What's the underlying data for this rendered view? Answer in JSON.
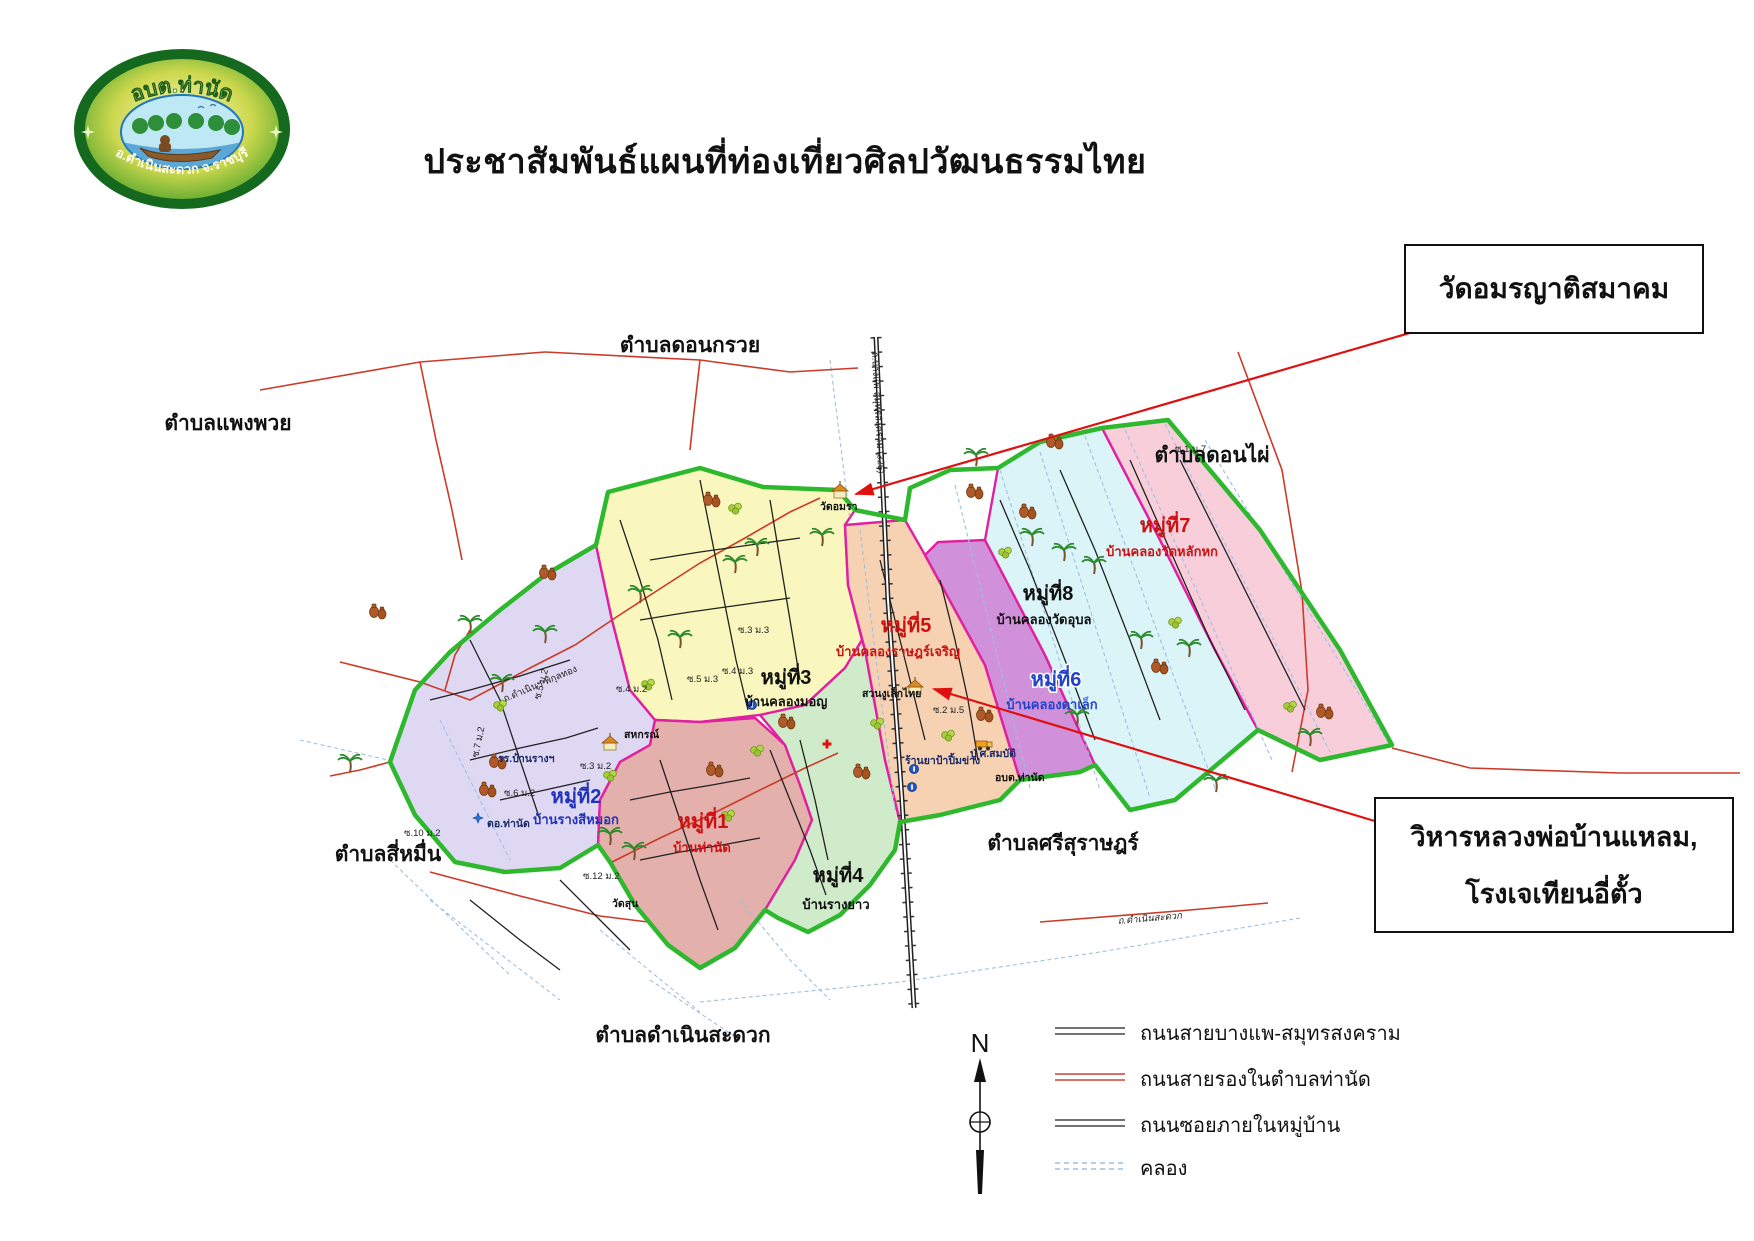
{
  "title": "ประชาสัมพันธ์แผนที่ท่องเที่ยวศิลปวัฒนธรรมไทย",
  "logo": {
    "top_text": "อบต.ท่านัด",
    "bottom_text": "อ.ดำเนินสะดวก จ.ราชบุรี"
  },
  "callouts": [
    {
      "text": "วัดอมรญาติสมาคม"
    },
    {
      "line1": "วิหารหลวงพ่อบ้านแหลม,",
      "line2": "โรงเจเทียนอี่ตั้ว"
    }
  ],
  "map": {
    "zones": [
      {
        "number": "หมู่ที่1",
        "name": "บ้านท่านัด",
        "fill": "#e3aca6",
        "label_color": "#cc1111"
      },
      {
        "number": "หมู่ที่2",
        "name": "บ้านรางสีหมอก",
        "fill": "#dcd6f2",
        "label_color": "#2233bb"
      },
      {
        "number": "หมู่ที่3",
        "name": "บ้านคลองมอญ",
        "fill": "#f9f6bb",
        "label_color": "#111111"
      },
      {
        "number": "หมู่ที่4",
        "name": "บ้านรางยาว",
        "fill": "#cdeac6",
        "label_color": "#111111"
      },
      {
        "number": "หมู่ที่5",
        "name": "บ้านคลองราษฎร์เจริญ",
        "fill": "#f6cfae",
        "label_color": "#cc1111"
      },
      {
        "number": "หมู่ที่6",
        "name": "บ้านคลองตาเล็ก",
        "fill": "#cd8bd8",
        "label_color": "#2244cc"
      },
      {
        "number": "หมู่ที่7",
        "name": "บ้านคลองวัดหลักหก",
        "fill": "#f8cbd9",
        "label_color": "#cc1111"
      },
      {
        "number": "หมู่ที่8",
        "name": "บ้านคลองวัดอุบล",
        "fill": "#d8f3f8",
        "label_color": "#111111"
      }
    ],
    "neighbor_subdistricts": [
      "ตำบลดอนกรวย",
      "ตำบลแพงพวย",
      "ตำบลดอนไผ่",
      "ตำบลสี่หมื่น",
      "ตำบลศรีสุราษฎร์",
      "ตำบลดำเนินสะดวก"
    ],
    "pois": [
      {
        "label": "วัดอมรา"
      },
      {
        "label": "สวนงูเล็กไทย"
      },
      {
        "label": "ร้านยาป้าปิ้มข่าง"
      },
      {
        "label": "ปู่ ศ.สมบัติ"
      },
      {
        "label": "อบต.ท่านัด"
      },
      {
        "label": "รร.บ้านรางฯ"
      },
      {
        "label": "สหกรณ์"
      },
      {
        "label": "ตอ.ท่านัด"
      },
      {
        "label": "วัดสุน"
      }
    ],
    "road_labels": [
      {
        "text": "ถ.บางแพ-สมุทรสงคราม (325)"
      },
      {
        "text": "ถ.ดำเนินฯ-พิกุลทอง"
      },
      {
        "text": "ถ.ดำเนินสะดวก"
      },
      {
        "text": "ซ.4 ม.2"
      },
      {
        "text": "ซ.5 ม.2"
      },
      {
        "text": "ซ.3 ม.2"
      },
      {
        "text": "ซ.6 ม.2"
      },
      {
        "text": "ซ.7 ม.2"
      },
      {
        "text": "ซ.10 ม.2"
      },
      {
        "text": "ซ.12 ม.2"
      },
      {
        "text": "ซ.2 ม.5"
      },
      {
        "text": "ซ.3 ม.3"
      },
      {
        "text": "ซ.4 ม.3"
      },
      {
        "text": "ซ.5 ม.3"
      },
      {
        "text": "ซ.1 ม.7"
      }
    ],
    "icons": {
      "palm": "palm-tree-icon",
      "jar": "pottery-jar-icon",
      "fruit": "fruit-cluster-icon",
      "temple": "temple-icon",
      "truck": "truck-icon",
      "info": "info-marker-icon",
      "cross": "red-cross-icon",
      "police": "police-badge-icon"
    }
  },
  "legend": {
    "items": [
      {
        "label": "ถนนสายบางแพ-สมุทรสงคราม",
        "line_color": "#444444",
        "style": "double-solid"
      },
      {
        "label": "ถนนสายรองในตำบลท่านัด",
        "line_color": "#cc4433",
        "style": "double-solid"
      },
      {
        "label": "ถนนซอยภายในหมู่บ้าน",
        "line_color": "#444444",
        "style": "double-solid"
      },
      {
        "label": "คลอง",
        "line_color": "#9fc0de",
        "style": "double-dashed",
        "label_color": "#cc22aa"
      }
    ]
  },
  "compass_label": "N",
  "colors": {
    "outer_boundary_green": "#2eb82e",
    "zone_border_magenta": "#e020a0",
    "secondary_road_red": "#cc3a28",
    "soi_road_black": "#222222",
    "canal_blue": "#9fc0de",
    "arrow_red": "#e01010"
  }
}
